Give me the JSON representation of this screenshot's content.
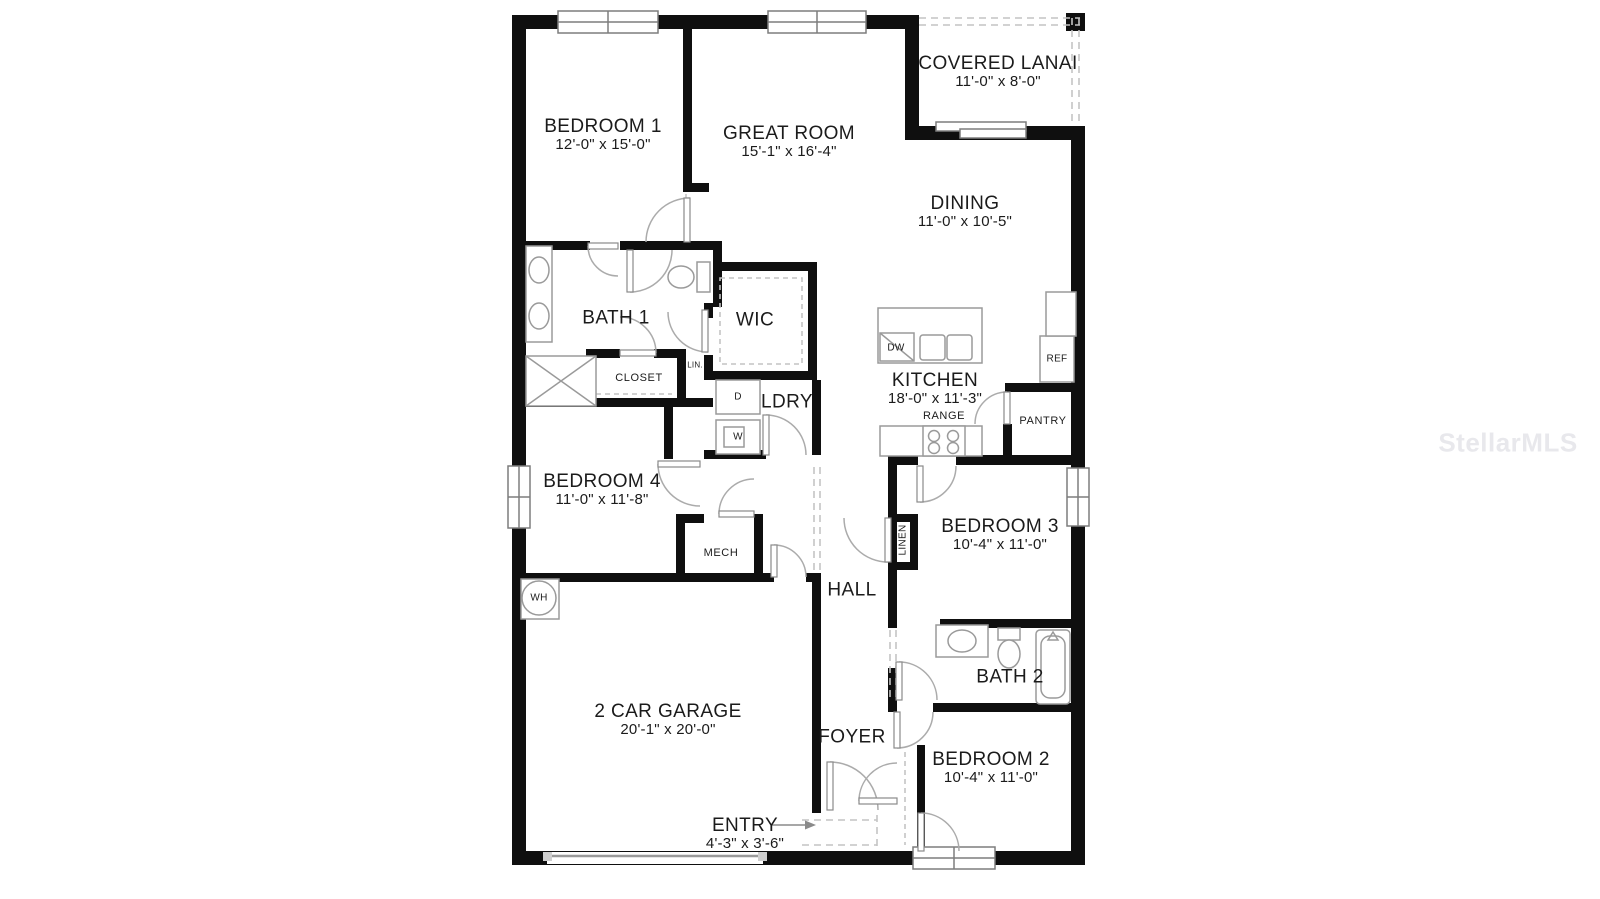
{
  "watermark": "StellarMLS",
  "rooms": {
    "bedroom1": {
      "name": "BEDROOM 1",
      "dims": "12'-0\" x 15'-0\""
    },
    "great_room": {
      "name": "GREAT ROOM",
      "dims": "15'-1\" x 16'-4\""
    },
    "covered_lanai": {
      "name": "COVERED LANAI",
      "dims": "11'-0\" x 8'-0\""
    },
    "dining": {
      "name": "DINING",
      "dims": "11'-0\" x 10'-5\""
    },
    "kitchen": {
      "name": "KITCHEN",
      "dims": "18'-0\" x 11'-3\""
    },
    "bath1": {
      "name": "BATH 1"
    },
    "wic": {
      "name": "WIC"
    },
    "ldry": {
      "name": "LDRY"
    },
    "bedroom4": {
      "name": "BEDROOM 4",
      "dims": "11'-0\" x 11'-8\""
    },
    "bedroom3": {
      "name": "BEDROOM 3",
      "dims": "10'-4\" x 11'-0\""
    },
    "hall": {
      "name": "HALL"
    },
    "bath2": {
      "name": "BATH 2"
    },
    "garage": {
      "name": "2 CAR GARAGE",
      "dims": "20'-1\" x 20'-0\""
    },
    "foyer": {
      "name": "FOYER"
    },
    "bedroom2": {
      "name": "BEDROOM 2",
      "dims": "10'-4\" x 11'-0\""
    },
    "entry": {
      "name": "ENTRY",
      "dims": "4'-3\" x 3'-6\""
    }
  },
  "fixtures": {
    "closet": "CLOSET",
    "lin": "LIN.",
    "linen": "LINEN",
    "mech": "MECH",
    "wh": "WH",
    "dryer": "D",
    "washer": "W",
    "dishwasher": "DW",
    "refrigerator": "REF",
    "range": "RANGE",
    "pantry": "PANTRY"
  },
  "colors": {
    "wall": "#0f0f0f",
    "fixture_outline": "#9a9a9a",
    "door": "#ababab",
    "dashed": "#c4c4c4",
    "text": "#1b1b1b",
    "watermark": "#e8e8ec",
    "background": "#ffffff"
  }
}
